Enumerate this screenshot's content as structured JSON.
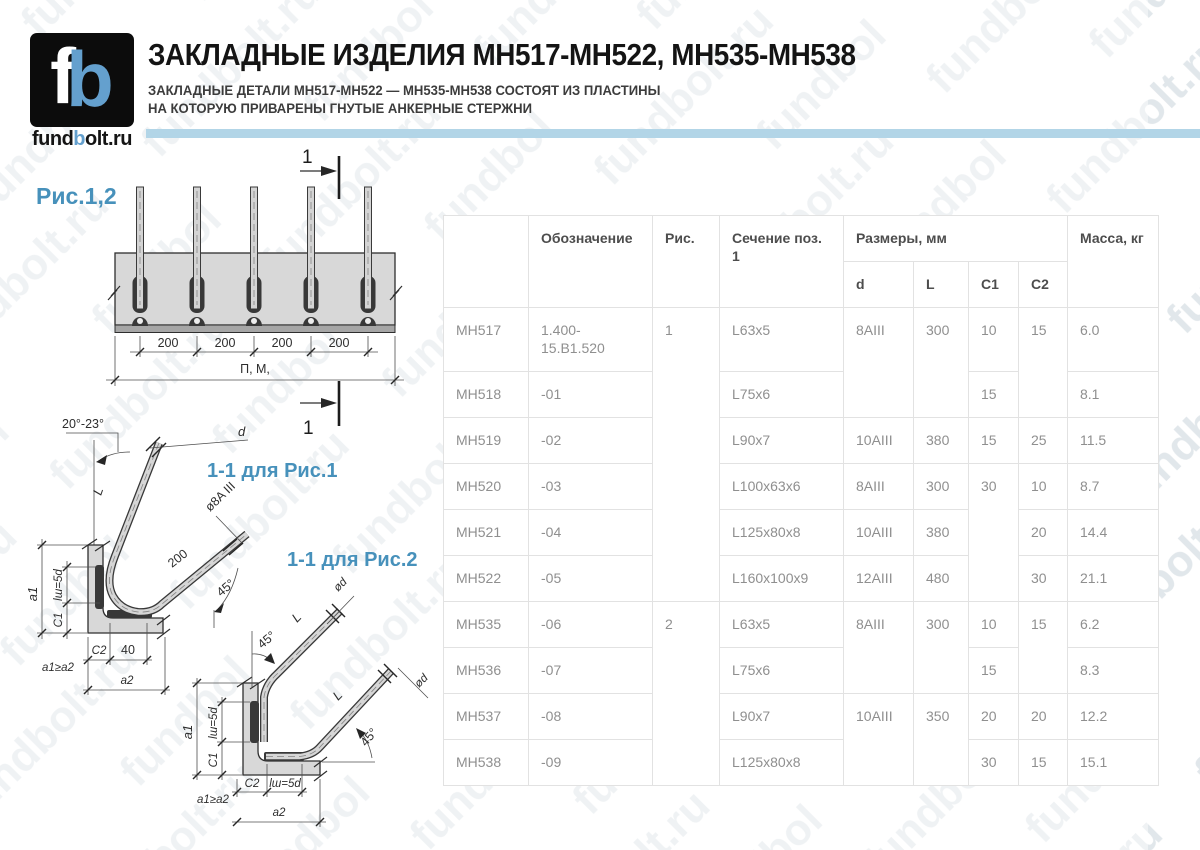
{
  "page": {
    "title": "ЗАКЛАДНЫЕ ИЗДЕЛИЯ МН517-МН522, МН535-МН538",
    "subtitle_line1": "ЗАКЛАДНЫЕ ДЕТАЛИ МН517-МН522 — МН535-МН538 СОСТОЯТ ИЗ ПЛАСТИНЫ",
    "subtitle_line2": "НА КОТОРУЮ ПРИВАРЕНЫ ГНУТЫЕ АНКЕРНЫЕ СТЕРЖНИ"
  },
  "logo": {
    "mark_f": "f",
    "mark_b": "b",
    "domain_prefix": "fund",
    "domain_accent": "b",
    "domain_suffix": "olt.ru"
  },
  "watermark": {
    "text": "fundbolt.ru"
  },
  "colors": {
    "accent_blue": "#4791bb",
    "logo_blue": "#64a0ce",
    "bar_blue": "#b2d5e7",
    "table_border": "#e2e2e2",
    "cell_text": "#8f8f8f",
    "header_text": "#4d4d4d"
  },
  "drawings": {
    "fig_label": "Рис.1,2",
    "plan": {
      "section_mark": "1",
      "spacing_dims": [
        "200",
        "200",
        "200",
        "200"
      ],
      "total_label": "П, М,"
    },
    "section1": {
      "title": "1-1 для Рис.1",
      "bend_angle": "20°-23°",
      "rod_d": "d",
      "rod_len": "L",
      "rod_spec": "ø8A III",
      "tail_len": "200",
      "tail_angle": "45°",
      "dim_a1": "a1",
      "dim_lw": "lш=5d",
      "dim_c1": "C1",
      "dim_c2": "C2",
      "dim_40": "40",
      "note": "a1≥a2",
      "dim_a2": "a2"
    },
    "section2": {
      "title": "1-1 для Рис.2",
      "angle_v": "45°",
      "angle_h": "45°",
      "rod_len_v": "L",
      "rod_len_h": "L",
      "rod_d_v": "ød",
      "rod_d_h": "ød",
      "dim_a1": "a1",
      "dim_lw_v": "lш=5d",
      "dim_c1": "C1",
      "dim_c2": "C2",
      "dim_lw_h": "lш=5d",
      "note": "a1≥a2",
      "dim_a2": "a2"
    }
  },
  "table": {
    "header": {
      "row1": [
        {
          "t": "",
          "rowspan": 2
        },
        {
          "t": "Обозначение",
          "rowspan": 2
        },
        {
          "t": "Рис.",
          "rowspan": 2
        },
        {
          "t": "Сечение поз. 1",
          "rowspan": 2
        },
        {
          "t": "Размеры, мм",
          "colspan": 4
        },
        {
          "t": "Масса, кг",
          "rowspan": 2
        }
      ],
      "row2": [
        {
          "t": "d"
        },
        {
          "t": "L"
        },
        {
          "t": "C1"
        },
        {
          "t": "C2"
        }
      ]
    },
    "rows": [
      {
        "cells": [
          {
            "t": "МН517"
          },
          {
            "t": "1.400-15.В1.520"
          },
          {
            "t": "1",
            "rowspan": 6
          },
          {
            "t": "L63x5"
          },
          {
            "t": "8AIII",
            "rowspan": 2
          },
          {
            "t": "300",
            "rowspan": 2
          },
          {
            "t": "10"
          },
          {
            "t": "15",
            "rowspan": 2
          },
          {
            "t": "6.0"
          }
        ]
      },
      {
        "cells": [
          {
            "t": "МН518"
          },
          {
            "t": "-01"
          },
          {
            "t": "L75x6"
          },
          {
            "t": "15"
          },
          {
            "t": "8.1"
          }
        ]
      },
      {
        "cells": [
          {
            "t": "МН519"
          },
          {
            "t": "-02"
          },
          {
            "t": "L90x7"
          },
          {
            "t": "10AIII"
          },
          {
            "t": "380"
          },
          {
            "t": "15"
          },
          {
            "t": "25"
          },
          {
            "t": "11.5"
          }
        ]
      },
      {
        "cells": [
          {
            "t": "МН520"
          },
          {
            "t": "-03"
          },
          {
            "t": "L100x63x6"
          },
          {
            "t": "8AIII"
          },
          {
            "t": "300"
          },
          {
            "t": "30",
            "rowspan": 3
          },
          {
            "t": "10"
          },
          {
            "t": "8.7"
          }
        ]
      },
      {
        "cells": [
          {
            "t": "МН521"
          },
          {
            "t": "-04"
          },
          {
            "t": "L125x80x8"
          },
          {
            "t": "10AIII"
          },
          {
            "t": "380"
          },
          {
            "t": "20"
          },
          {
            "t": "14.4"
          }
        ]
      },
      {
        "cells": [
          {
            "t": "МН522"
          },
          {
            "t": "-05"
          },
          {
            "t": "L160x100x9"
          },
          {
            "t": "12AIII"
          },
          {
            "t": "480"
          },
          {
            "t": "30"
          },
          {
            "t": "21.1"
          }
        ]
      },
      {
        "cells": [
          {
            "t": "МН535"
          },
          {
            "t": "-06"
          },
          {
            "t": "2",
            "rowspan": 4
          },
          {
            "t": "L63x5"
          },
          {
            "t": "8AIII",
            "rowspan": 2
          },
          {
            "t": "300",
            "rowspan": 2
          },
          {
            "t": "10"
          },
          {
            "t": "15",
            "rowspan": 2
          },
          {
            "t": "6.2"
          }
        ]
      },
      {
        "cells": [
          {
            "t": "МН536"
          },
          {
            "t": "-07"
          },
          {
            "t": "L75x6"
          },
          {
            "t": "15"
          },
          {
            "t": "8.3"
          }
        ]
      },
      {
        "cells": [
          {
            "t": "МН537"
          },
          {
            "t": "-08"
          },
          {
            "t": "L90x7"
          },
          {
            "t": "10AIII",
            "rowspan": 2
          },
          {
            "t": "350",
            "rowspan": 2
          },
          {
            "t": "20"
          },
          {
            "t": "20"
          },
          {
            "t": "12.2"
          }
        ]
      },
      {
        "cells": [
          {
            "t": "МН538"
          },
          {
            "t": "-09"
          },
          {
            "t": "L125x80x8"
          },
          {
            "t": "30"
          },
          {
            "t": "15"
          },
          {
            "t": "15.1"
          }
        ]
      }
    ]
  }
}
